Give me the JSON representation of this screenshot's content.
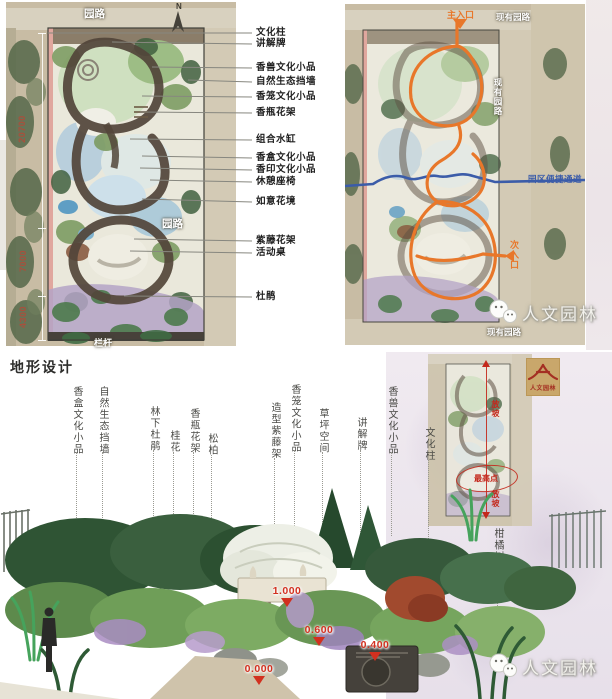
{
  "left_plan": {
    "road_top": "园路",
    "road_mid": "园路",
    "railing": "栏杆",
    "north": "N",
    "dims": [
      "20700",
      "7000",
      "4300"
    ],
    "callouts": [
      "文化柱",
      "讲解牌",
      "香兽文化小品",
      "自然生态挡墙",
      "香笼文化小品",
      "香瓶花架",
      "组合水缸",
      "香盒文化小品",
      "香印文化小品",
      "休憩座椅",
      "如意花境",
      "紫藤花架",
      "活动桌",
      "杜鹃"
    ]
  },
  "right_plan": {
    "main_entrance": "主入口",
    "side_entrance": "次入口",
    "existing_road_top": "现有园路",
    "existing_road_right": "现有园路",
    "existing_road_bottom": "现有园路",
    "shortcut": "园区便捷通道",
    "watermark": "人文园林"
  },
  "terrain": {
    "title": "地形设计",
    "labels": [
      "香盒文化小品",
      "自然生态挡墙",
      "林下杜鹃",
      "桂花",
      "香瓶花架",
      "松柏",
      "造型紫藤架",
      "香笼文化小品",
      "草坪空间",
      "讲解牌",
      "香兽文化小品",
      "文化柱",
      "柑橘树"
    ],
    "elevations": [
      "1.000",
      "0.600",
      "0.400",
      "0.000"
    ],
    "inset": {
      "slope_top": "放坡",
      "peak": "最高点",
      "slope_bottom": "放坡"
    },
    "logo_text": "人文园林",
    "watermark": "人文园林"
  },
  "colors": {
    "accent_orange": "#e8772a",
    "accent_blue": "#3b5ca9",
    "annotation_red": "#c4281c",
    "elevation_red": "#d2301f",
    "dimension_red": "#a8503c",
    "logo_gold": "#c9a76b"
  }
}
